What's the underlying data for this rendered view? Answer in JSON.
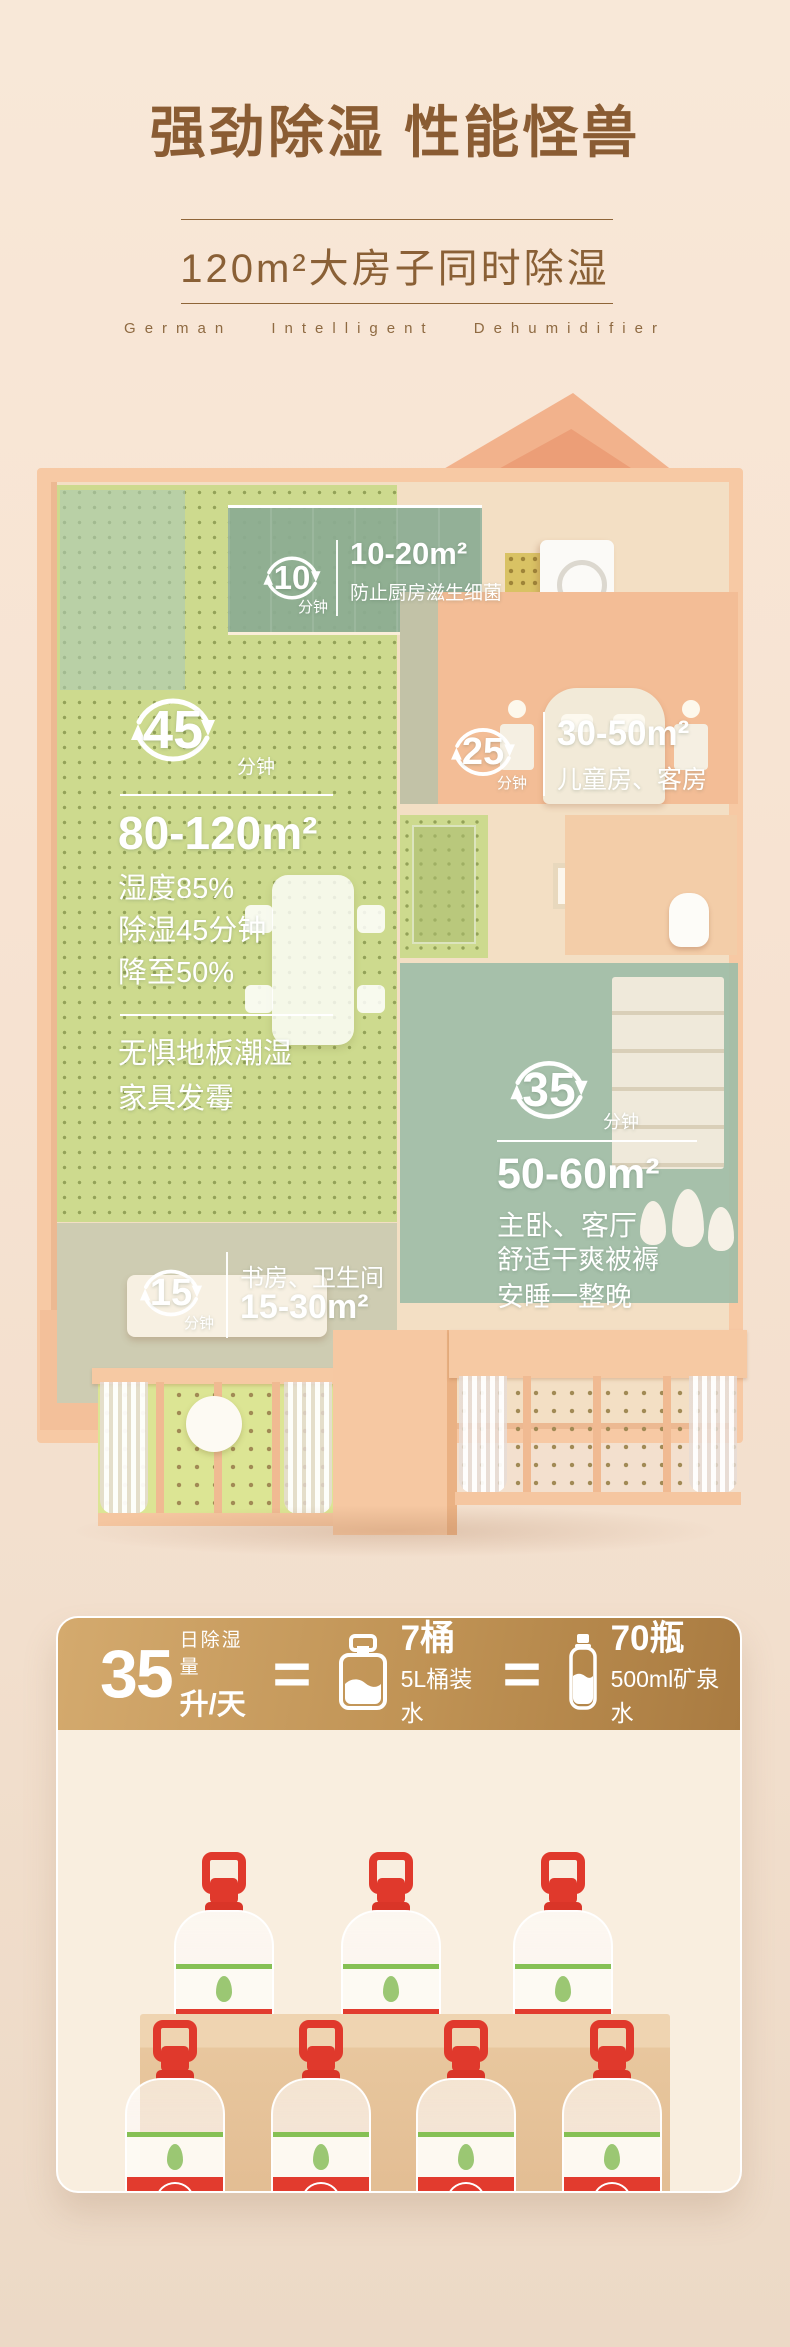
{
  "header": {
    "title": "强劲除湿 性能怪兽",
    "subtitle": "120m²大房子同时除湿",
    "tagline": "German Intelligent Dehumidifier"
  },
  "floorplan": {
    "annotations": [
      {
        "minutes": "10",
        "unit": "分钟",
        "area": "10-20m²",
        "desc": "防止厨房滋生细菌"
      },
      {
        "minutes": "45",
        "unit": "分钟",
        "area": "80-120m²",
        "stat1": "湿度85%",
        "stat2": "除湿45分钟",
        "stat3": "降至50%",
        "benefit1": "无惧地板潮湿",
        "benefit2": "家具发霉"
      },
      {
        "minutes": "25",
        "unit": "分钟",
        "area": "30-50m²",
        "desc": "儿童房、客房"
      },
      {
        "minutes": "35",
        "unit": "分钟",
        "area": "50-60m²",
        "desc": "主卧、客厅",
        "benefit1": "舒适干爽被褥",
        "benefit2": "安睡一整晚"
      },
      {
        "minutes": "15",
        "unit": "分钟",
        "rooms": "书房、卫生间",
        "area": "15-30m²"
      }
    ]
  },
  "card": {
    "daily_label": "日除湿量",
    "daily_value": "35",
    "daily_unit": "升/天",
    "equals": "=",
    "jug_count": "7桶",
    "jug_desc": "5L桶装水",
    "bottle_count": "70瓶",
    "bottle_desc": "500ml矿泉水",
    "bottle_label": "5L"
  },
  "icons": {
    "timer": "circular-refresh-arrows",
    "jug": "water-jug-5l",
    "bottle": "water-bottle-500ml"
  },
  "colors": {
    "background": "#f7e4d4",
    "title_brown": "#8a5c33",
    "gold_start": "#d4aa6e",
    "gold_end": "#a97b41",
    "red": "#e23b2e",
    "floor_green": "#cdda8e",
    "glass_teal": "#9ab8a0",
    "wall_peach": "#f7c9a4",
    "text_white": "#ffffff"
  }
}
